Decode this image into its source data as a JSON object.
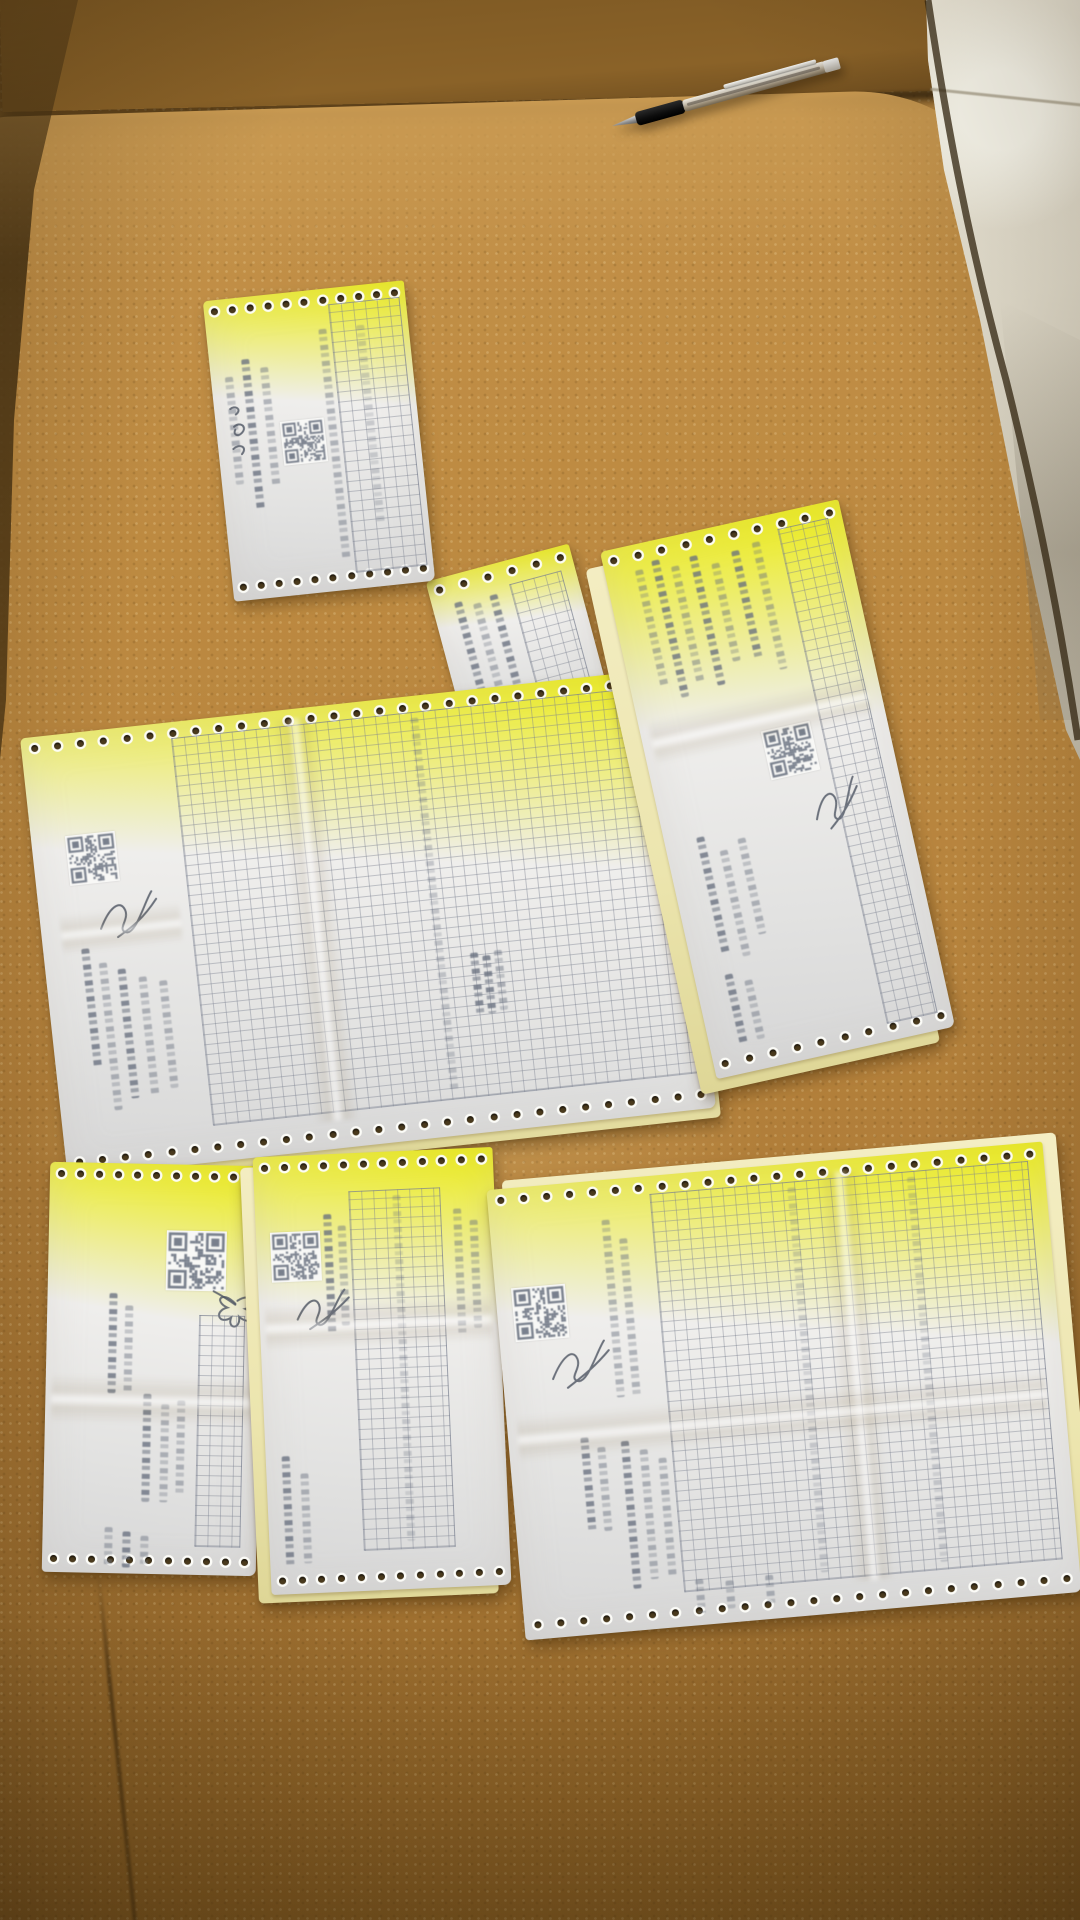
{
  "scene": {
    "description": "Overhead photograph of six dot-matrix printed carbon-copy delivery receipts laid out on a tan pebbled-leather sofa seat; a ballpoint pen rests on the backrest seam at the top; white tile floor is visible at the top-right corner.",
    "surface": {
      "type": "leather sofa seat",
      "texture": "pebbled",
      "color": "#b5823c"
    },
    "floor": {
      "type": "glossy tile",
      "color": "#e9e4d6",
      "visible": "top-right corner"
    },
    "pen": {
      "type": "ballpoint pen",
      "grip_color": "black",
      "barrel": "translucent silver",
      "orientation": "diagonal, top center"
    },
    "text_legibility": "all printed Chinese dot-matrix text is blurred and illegible",
    "colors": {
      "sofa_main": "#b5823c",
      "sofa_back": "#8a6228",
      "sofa_shadow": "#5d4119",
      "tile": "#e9e4d6",
      "paper_white": "#efeeec",
      "paper_carbon_yellow": "#ece5ae",
      "dot_matrix_ink": "#68707f",
      "signature_ink": "#4e5563",
      "hole_punch": "#4a3a1d"
    }
  },
  "documents": [
    {
      "id": "doc-top",
      "name": "receipt top center",
      "type": "continuous-form dot-matrix receipt",
      "sheets": [
        "white"
      ],
      "features": [
        "tractor-feed hole strips top and bottom",
        "QR code",
        "handwritten pen annotation",
        "fine item grid on right half",
        "vertical illegible print"
      ],
      "rotation_deg": -6
    },
    {
      "id": "doc-center",
      "name": "large receipt center",
      "type": "continuous-form dot-matrix receipt",
      "sheets": [
        "white",
        "yellow carbon"
      ],
      "features": [
        "tractor-feed hole strips top and bottom",
        "QR code at left",
        "handwritten signature",
        "large item grid",
        "folded corner page attached at top right"
      ],
      "rotation_deg": -6
    },
    {
      "id": "doc-right",
      "name": "receipt right side",
      "type": "continuous-form dot-matrix receipt",
      "sheets": [
        "white",
        "yellow carbon offset left"
      ],
      "features": [
        "tractor-feed hole strips top and bottom",
        "QR code",
        "handwritten signature",
        "narrow item grid along right edge",
        "vertical illegible print"
      ],
      "rotation_deg": -12
    },
    {
      "id": "doc-bottom-left",
      "name": "receipt bottom left",
      "type": "continuous-form dot-matrix receipt",
      "sheets": [
        "white"
      ],
      "features": [
        "tractor-feed hole strips top and bottom",
        "QR code",
        "flower-shaped signature scribble",
        "narrow item grid",
        "horizontal fold crease"
      ],
      "rotation_deg": 1
    },
    {
      "id": "doc-bottom-middle",
      "name": "receipt bottom middle",
      "type": "continuous-form dot-matrix receipt",
      "sheets": [
        "white",
        "yellow carbon offset left"
      ],
      "features": [
        "tractor-feed hole strips top and bottom",
        "QR code",
        "handwritten signature",
        "wavy item grid",
        "fold crease"
      ],
      "rotation_deg": -2
    },
    {
      "id": "doc-bottom-right",
      "name": "large receipt bottom right",
      "type": "continuous-form dot-matrix receipt",
      "sheets": [
        "white",
        "yellow carbon offset right"
      ],
      "features": [
        "tractor-feed hole strips top and bottom",
        "QR code",
        "handwritten signature",
        "large item grid",
        "vertical illegible print"
      ],
      "rotation_deg": -5
    }
  ]
}
